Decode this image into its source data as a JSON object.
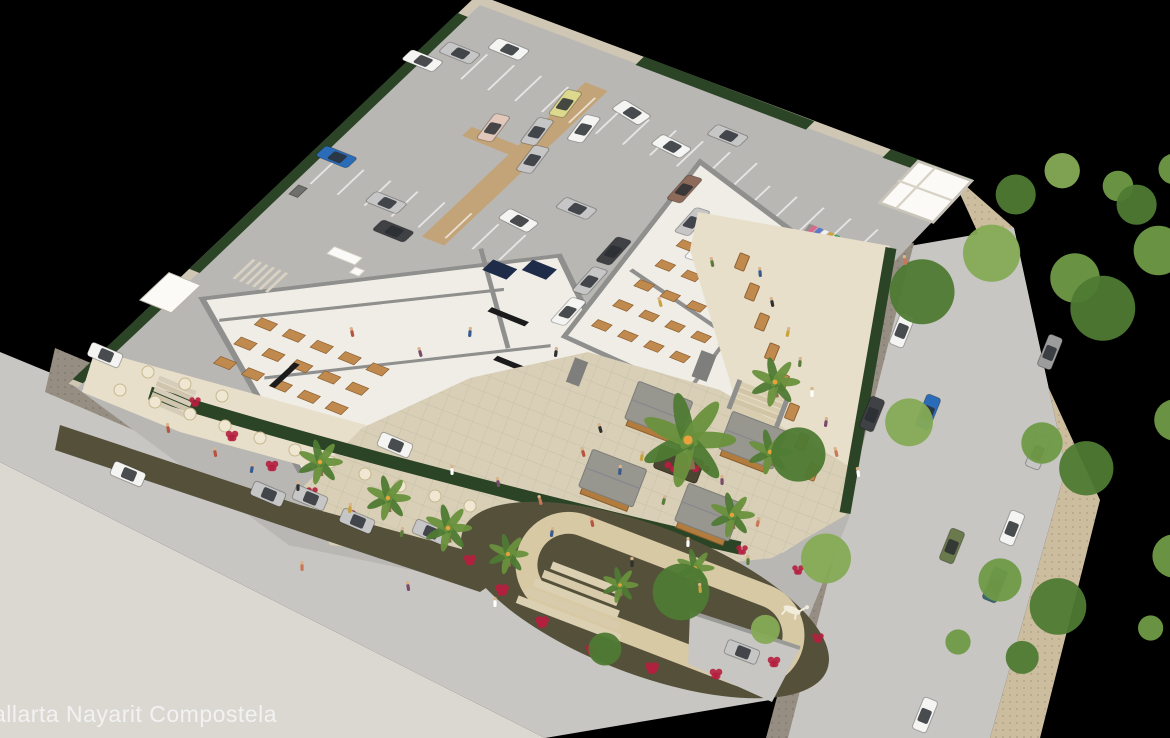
{
  "caption": {
    "text": "allarta Nayarit Compostela",
    "color": "#f2f2f2"
  },
  "palette": {
    "background": "#000000",
    "parking": "#b9b7b4",
    "street": "#c8c6c2",
    "cobble": "#968e82",
    "sidewalk": "#dbd8d2",
    "sidewalk_tan": "#cdbd9f",
    "apron": "#d8d2c6",
    "wall": "#cfc7b4",
    "hedge": "#2c4426",
    "floor": "#f0ede7",
    "wall_gray": "#8f8f8d",
    "white_wall": "#fbfaf6",
    "terrace": "#e8dfca",
    "plaza": "#d8cfb6",
    "kiosk_roof": "#97968f",
    "kiosk_wood": "#b27c3e",
    "garden_bed": "#55503a",
    "garden_path": "#d8c9a5",
    "flower_red": "#b51f3f",
    "wood_table": "#c08a4f",
    "cream_table": "#efe7d2",
    "tan_path": "#c3a478",
    "tree_green_1": "#6f9a46",
    "tree_green_2": "#85ab55",
    "tree_green_3": "#4e7a33",
    "palm_green_1": "#4e7a33",
    "palm_green_2": "#69913d",
    "trunk": "#8a6f4e",
    "solar_panel": "#1f2c49",
    "board_black": "#1b1b1b",
    "car_colors": {
      "white": "#f4f4f2",
      "silver": "#c6c6c6",
      "dark": "#3f4145",
      "blue": "#2b6cb8",
      "yellow": "#dcd98f",
      "pink": "#e2c8ba",
      "brown": "#8d6a5a",
      "green": "#6b7a4d",
      "teal": "#3b6b72",
      "gray": "#9c9c9c"
    }
  },
  "scene": {
    "description": "Aerial 3D architectural rendering of a commercial plaza with rooftop parking lot, retail and food-hall buildings, dining terraces, kiosk plaza with central palm, looping garden path with a white animal sculpture, and surrounding streets with cars and trees",
    "parking_cars": [
      [
        62,
        26,
        0,
        "white"
      ],
      [
        28,
        50,
        0,
        "silver"
      ],
      [
        6,
        73,
        0,
        "white"
      ],
      [
        148,
        58,
        80,
        "yellow"
      ],
      [
        182,
        76,
        80,
        "white"
      ],
      [
        149,
        98,
        80,
        "silver"
      ],
      [
        113,
        112,
        80,
        "pink"
      ],
      [
        168,
        128,
        80,
        "silver"
      ],
      [
        205,
        40,
        10,
        "white"
      ],
      [
        262,
        58,
        5,
        "white"
      ],
      [
        306,
        96,
        85,
        "brown"
      ],
      [
        338,
        126,
        85,
        "silver"
      ],
      [
        366,
        148,
        85,
        "white"
      ],
      [
        240,
        160,
        0,
        "silver"
      ],
      [
        206,
        196,
        5,
        "white"
      ],
      [
        18,
        206,
        0,
        "blue"
      ],
      [
        92,
        232,
        0,
        "silver"
      ],
      [
        120,
        258,
        0,
        "dark"
      ],
      [
        296,
        24,
        0,
        "silver"
      ],
      [
        302,
        188,
        85,
        "dark"
      ],
      [
        308,
        228,
        85,
        "silver"
      ],
      [
        316,
        268,
        85,
        "white"
      ]
    ],
    "street_cars": [
      [
        105,
        355,
        23,
        "white"
      ],
      [
        128,
        474,
        23,
        "white"
      ],
      [
        395,
        445,
        23,
        "white"
      ],
      [
        268,
        494,
        23,
        "silver"
      ],
      [
        357,
        521,
        23,
        "silver"
      ],
      [
        742,
        652,
        21,
        "silver"
      ],
      [
        902,
        330,
        112,
        "white"
      ],
      [
        928,
        412,
        112,
        "blue"
      ],
      [
        872,
        414,
        112,
        "dark"
      ],
      [
        1050,
        352,
        112,
        "gray"
      ],
      [
        1038,
        452,
        112,
        "silver"
      ],
      [
        1012,
        528,
        112,
        "white"
      ],
      [
        952,
        546,
        112,
        "green"
      ],
      [
        995,
        585,
        112,
        "teal"
      ],
      [
        925,
        715,
        112,
        "white"
      ]
    ],
    "terrace_cars": [
      [
        310,
        498,
        23,
        "silver"
      ],
      [
        430,
        532,
        23,
        "silver"
      ]
    ],
    "kiosks": [
      [
        658,
        412,
        21
      ],
      [
        752,
        442,
        21
      ],
      [
        612,
        480,
        21
      ],
      [
        708,
        514,
        21
      ]
    ],
    "central_palm": [
      688,
      440
    ],
    "palms": [
      [
        320,
        462,
        1
      ],
      [
        388,
        498,
        1
      ],
      [
        448,
        528,
        1.05
      ],
      [
        508,
        554,
        0.9
      ],
      [
        775,
        382,
        1.1
      ],
      [
        770,
        452,
        1
      ],
      [
        732,
        515,
        1
      ],
      [
        695,
        568,
        0.85
      ],
      [
        620,
        585,
        0.8
      ]
    ],
    "trees": [
      [
        1075,
        278,
        55
      ],
      [
        1118,
        186,
        34
      ],
      [
        1042,
        443,
        46
      ],
      [
        1000,
        580,
        48
      ],
      [
        958,
        642,
        28
      ]
    ],
    "people_colors": [
      "#b5553f",
      "#3a5a8c",
      "#2f2f2f",
      "#c8a23c",
      "#5a7a3a",
      "#ffffff",
      "#7a4a6a",
      "#c87858"
    ],
    "people": [
      [
        215,
        452
      ],
      [
        252,
        468
      ],
      [
        298,
        486
      ],
      [
        350,
        508
      ],
      [
        402,
        532
      ],
      [
        452,
        470
      ],
      [
        498,
        482
      ],
      [
        540,
        500
      ],
      [
        583,
        452
      ],
      [
        620,
        470
      ],
      [
        600,
        428
      ],
      [
        642,
        456
      ],
      [
        664,
        500
      ],
      [
        688,
        542
      ],
      [
        722,
        480
      ],
      [
        758,
        522
      ],
      [
        592,
        522
      ],
      [
        552,
        532
      ],
      [
        632,
        562
      ],
      [
        700,
        588
      ],
      [
        748,
        560
      ],
      [
        495,
        602
      ],
      [
        408,
        586
      ],
      [
        302,
        566
      ],
      [
        168,
        428
      ],
      [
        760,
        272
      ],
      [
        772,
        302
      ],
      [
        788,
        332
      ],
      [
        800,
        362
      ],
      [
        812,
        392
      ],
      [
        826,
        422
      ],
      [
        836,
        452
      ],
      [
        352,
        332
      ],
      [
        470,
        332
      ],
      [
        556,
        352
      ],
      [
        660,
        302
      ],
      [
        712,
        262
      ],
      [
        858,
        472
      ],
      [
        420,
        352
      ],
      [
        905,
        260
      ]
    ],
    "flowers": [
      [
        470,
        560,
        6
      ],
      [
        502,
        590,
        7
      ],
      [
        542,
        622,
        7
      ],
      [
        592,
        650,
        6
      ],
      [
        652,
        668,
        7
      ],
      [
        716,
        674,
        6
      ],
      [
        774,
        662,
        6
      ],
      [
        818,
        638,
        5
      ],
      [
        798,
        570,
        5
      ],
      [
        742,
        550,
        5
      ],
      [
        195,
        402,
        5
      ],
      [
        232,
        436,
        6
      ],
      [
        272,
        466,
        6
      ],
      [
        312,
        492,
        5
      ],
      [
        350,
        515,
        5
      ]
    ],
    "terrace_tables": [
      [
        120,
        390
      ],
      [
        155,
        402
      ],
      [
        190,
        414
      ],
      [
        225,
        426
      ],
      [
        260,
        438
      ],
      [
        295,
        450
      ],
      [
        330,
        462
      ],
      [
        365,
        474
      ],
      [
        400,
        486
      ],
      [
        435,
        496
      ],
      [
        470,
        506
      ],
      [
        148,
        372
      ],
      [
        185,
        384
      ],
      [
        222,
        396
      ]
    ],
    "right_terrace_tables": [
      [
        742,
        262
      ],
      [
        752,
        292
      ],
      [
        762,
        322
      ],
      [
        772,
        352
      ],
      [
        782,
        382
      ],
      [
        792,
        412
      ],
      [
        802,
        442
      ],
      [
        812,
        472
      ]
    ],
    "left_tables": {
      "s0": 90,
      "t0": 400,
      "cols": 5,
      "rows": 3,
      "ds": 30,
      "dt": 28,
      "w": 17,
      "h": 10
    },
    "hall_tables": {
      "s0": 345,
      "t0": 148,
      "cols": 4,
      "rows": 5,
      "ds": 28,
      "dt": 29,
      "w": 15,
      "h": 9
    },
    "parking_rows": [
      [
        50,
        40,
        11,
        36
      ],
      [
        20,
        208,
        8,
        36
      ],
      [
        368,
        58,
        5,
        34
      ]
    ],
    "bollards": [
      [
        12,
        250
      ],
      [
        118,
        252
      ],
      [
        222,
        254
      ],
      [
        268,
        252
      ],
      [
        360,
        128
      ],
      [
        300,
        70
      ]
    ],
    "market_shelves": [
      [
        455,
        100
      ],
      [
        474,
        109
      ],
      [
        493,
        118
      ]
    ],
    "colorwall_colors": [
      "#c0392b",
      "#3466c0",
      "#e8c022",
      "#3a8a3a",
      "#c03ac0",
      "#222222",
      "#e87330",
      "#3999c9"
    ],
    "rack_colors": [
      "#d86a8a",
      "#5a79c8",
      "#f0f0f0",
      "#caa23c",
      "#49a06a"
    ]
  }
}
